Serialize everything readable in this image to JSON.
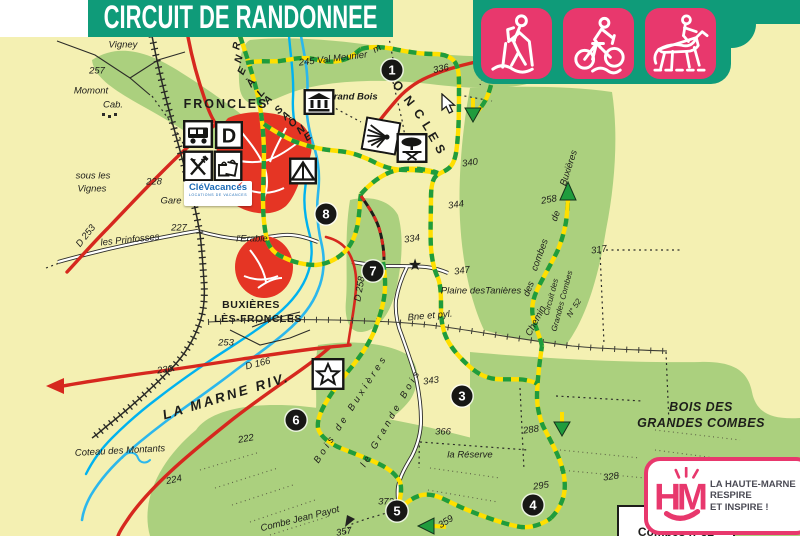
{
  "banner": {
    "title": "CIRCUIT DE RANDONNEE"
  },
  "activities": [
    {
      "name": "hiking"
    },
    {
      "name": "mountain-biking"
    },
    {
      "name": "horse-riding"
    }
  ],
  "theme": {
    "banner_teal": "#0f9b79",
    "activity_pink": "#e8386d",
    "map_background": "#f4f0b2",
    "forest_green": "#abd07e",
    "trail_yellow": "#ffdf00",
    "trail_green": "#1f9c3d",
    "road_red": "#d6281e",
    "river_blue": "#2cb7ec",
    "urban_red": "#e53524"
  },
  "logos": {
    "clevacances": {
      "text": "CléVacances",
      "subtext": "LOCATIONS DE VACANCES"
    },
    "haute_marne": {
      "line1": "LA HAUTE-MARNE",
      "line2": "RESPIRE",
      "line3": "ET INSPIRE !"
    },
    "circuit_box": {
      "line1": "Circuit",
      "line2": "Combes n°52"
    }
  },
  "map": {
    "waypoints": [
      {
        "n": "1",
        "x": 392,
        "y": 70
      },
      {
        "n": "3",
        "x": 462,
        "y": 396
      },
      {
        "n": "4",
        "x": 533,
        "y": 505
      },
      {
        "n": "5",
        "x": 397,
        "y": 511
      },
      {
        "n": "6",
        "x": 296,
        "y": 420
      },
      {
        "n": "7",
        "x": 373,
        "y": 271
      },
      {
        "n": "8",
        "x": 326,
        "y": 214
      }
    ],
    "labels": [
      {
        "t": "Vigney",
        "x": 123,
        "y": 45
      },
      {
        "t": "257",
        "x": 97,
        "y": 71
      },
      {
        "t": "Momont",
        "x": 91,
        "y": 91
      },
      {
        "t": "Cab.",
        "x": 113,
        "y": 105
      },
      {
        "t": "sous les",
        "x": 93,
        "y": 176
      },
      {
        "t": "Vignes",
        "x": 92,
        "y": 189
      },
      {
        "t": "228",
        "x": 154,
        "y": 182
      },
      {
        "t": "D 253",
        "x": 86,
        "y": 236,
        "rot": -52
      },
      {
        "t": "les Prinfosses",
        "x": 130,
        "y": 240,
        "rot": -6
      },
      {
        "t": "227",
        "x": 179,
        "y": 228
      },
      {
        "t": "Gare",
        "x": 171,
        "y": 201
      },
      {
        "t": "l'Erable",
        "x": 252,
        "y": 239
      },
      {
        "t": "FRONCLES",
        "x": 226,
        "y": 104,
        "cls": "town"
      },
      {
        "t": "Coteau des Montants",
        "x": 120,
        "y": 451,
        "rot": -3
      },
      {
        "t": "BUXIÈRES",
        "x": 251,
        "y": 305,
        "cls": "town2"
      },
      {
        "t": "LÈS-FRONCLES",
        "x": 258,
        "y": 319,
        "cls": "town2"
      },
      {
        "t": "253",
        "x": 226,
        "y": 343
      },
      {
        "t": "230",
        "x": 165,
        "y": 370,
        "rot": -8
      },
      {
        "t": "D 166",
        "x": 258,
        "y": 364,
        "rot": -14
      },
      {
        "t": "LA MARNE RIV.",
        "x": 226,
        "y": 396,
        "cls": "river",
        "rot": -17
      },
      {
        "t": "222",
        "x": 246,
        "y": 439,
        "rot": -10
      },
      {
        "t": "224",
        "x": 174,
        "y": 480,
        "rot": -12
      },
      {
        "t": "Combe Jean Payot",
        "x": 300,
        "y": 519,
        "rot": -14
      },
      {
        "t": "357",
        "x": 344,
        "y": 532,
        "rot": -10
      },
      {
        "t": "372",
        "x": 386,
        "y": 502
      },
      {
        "t": "359",
        "x": 446,
        "y": 522,
        "rot": -32
      },
      {
        "t": "343",
        "x": 431,
        "y": 381,
        "rot": -8
      },
      {
        "t": "366",
        "x": 443,
        "y": 432
      },
      {
        "t": "la Réserve",
        "x": 470,
        "y": 455
      },
      {
        "t": "334",
        "x": 412,
        "y": 239,
        "rot": -8
      },
      {
        "t": "344",
        "x": 456,
        "y": 205,
        "rot": -8
      },
      {
        "t": "347",
        "x": 462,
        "y": 271,
        "rot": -8
      },
      {
        "t": "Plaine desTanières",
        "x": 481,
        "y": 291
      },
      {
        "t": "Bne et pyl.",
        "x": 430,
        "y": 316,
        "rot": -5
      },
      {
        "t": "D 258",
        "x": 360,
        "y": 289,
        "rot": -80
      },
      {
        "t": "317",
        "x": 599,
        "y": 250,
        "rot": -8
      },
      {
        "t": "Chemin",
        "x": 536,
        "y": 321,
        "rot": -62
      },
      {
        "t": "des",
        "x": 529,
        "y": 289,
        "rot": -68
      },
      {
        "t": "combes",
        "x": 540,
        "y": 255,
        "rot": -70
      },
      {
        "t": "de",
        "x": 556,
        "y": 216,
        "rot": -70
      },
      {
        "t": "Buxières",
        "x": 569,
        "y": 168,
        "rot": -72
      },
      {
        "t": "258",
        "x": 549,
        "y": 200,
        "rot": -10
      },
      {
        "t": "Circuit des",
        "x": 551,
        "y": 297,
        "cls": "sm",
        "rot": -75
      },
      {
        "t": "Grandes Combes",
        "x": 562,
        "y": 301,
        "cls": "sm",
        "rot": -75
      },
      {
        "t": "N° 52",
        "x": 574,
        "y": 308,
        "cls": "sm",
        "rot": -58
      },
      {
        "t": "340",
        "x": 470,
        "y": 163,
        "rot": -8
      },
      {
        "t": "336",
        "x": 441,
        "y": 69,
        "rot": -12
      },
      {
        "t": "245 Val Meunier",
        "x": 333,
        "y": 59,
        "rot": -7
      },
      {
        "t": "m",
        "x": 377,
        "y": 49,
        "rot": -30
      },
      {
        "t": "Grand Bois",
        "x": 352,
        "y": 97,
        "cls": "itb"
      },
      {
        "t": "BOIS DES",
        "x": 701,
        "y": 407,
        "cls": "forest"
      },
      {
        "t": "GRANDES COMBES",
        "x": 701,
        "y": 423,
        "cls": "forest"
      },
      {
        "t": "288",
        "x": 531,
        "y": 430,
        "rot": -8
      },
      {
        "t": "295",
        "x": 541,
        "y": 486,
        "rot": -8
      },
      {
        "t": "328",
        "x": 611,
        "y": 477,
        "rot": -8
      },
      {
        "t": "Bois de Buxières",
        "x": 351,
        "y": 409,
        "cls": "spread",
        "rot": -57
      },
      {
        "t": "le Grande Bois",
        "x": 391,
        "y": 418,
        "cls": "spread",
        "rot": -60
      },
      {
        "t": "★",
        "x": 415,
        "y": 265,
        "cls": "starsym"
      }
    ],
    "canal_letters": [
      {
        "ch": "R",
        "x": 237,
        "y": 46,
        "r": -80
      },
      {
        "ch": "N",
        "x": 239,
        "y": 59,
        "r": -75
      },
      {
        "ch": "E",
        "x": 242,
        "y": 71,
        "r": -65
      },
      {
        "ch": "À",
        "x": 251,
        "y": 83,
        "r": -55
      },
      {
        "ch": "L",
        "x": 261,
        "y": 93,
        "r": -50
      },
      {
        "ch": "A",
        "x": 268,
        "y": 100,
        "r": -48
      },
      {
        "ch": "S",
        "x": 279,
        "y": 110,
        "r": -45
      },
      {
        "ch": "A",
        "x": 286,
        "y": 116,
        "r": -43
      },
      {
        "ch": "Ô",
        "x": 293,
        "y": 123,
        "r": -40
      },
      {
        "ch": "N",
        "x": 301,
        "y": 130,
        "r": -38
      },
      {
        "ch": "E",
        "x": 308,
        "y": 137,
        "r": -36
      }
    ],
    "hill_letters": [
      {
        "ch": "O",
        "x": 398,
        "y": 86,
        "r": 50
      },
      {
        "ch": "N",
        "x": 409,
        "y": 101,
        "r": 52
      },
      {
        "ch": "C",
        "x": 419,
        "y": 114,
        "r": 55
      },
      {
        "ch": "L",
        "x": 427,
        "y": 126,
        "r": 58
      },
      {
        "ch": "E",
        "x": 433,
        "y": 137,
        "r": 60
      },
      {
        "ch": "S",
        "x": 440,
        "y": 149,
        "r": 62
      }
    ],
    "icons": [
      {
        "type": "camper",
        "x": 198,
        "y": 134
      },
      {
        "type": "depart",
        "x": 229,
        "y": 135
      },
      {
        "type": "restaurant",
        "x": 198,
        "y": 166
      },
      {
        "type": "shops",
        "x": 228,
        "y": 166
      },
      {
        "type": "camping",
        "x": 303,
        "y": 171
      },
      {
        "type": "monument",
        "x": 319,
        "y": 102
      },
      {
        "type": "viewpoint",
        "x": 381,
        "y": 136,
        "rot": 10
      },
      {
        "type": "picnic",
        "x": 412,
        "y": 148
      },
      {
        "type": "star-box",
        "x": 328,
        "y": 374
      }
    ]
  }
}
